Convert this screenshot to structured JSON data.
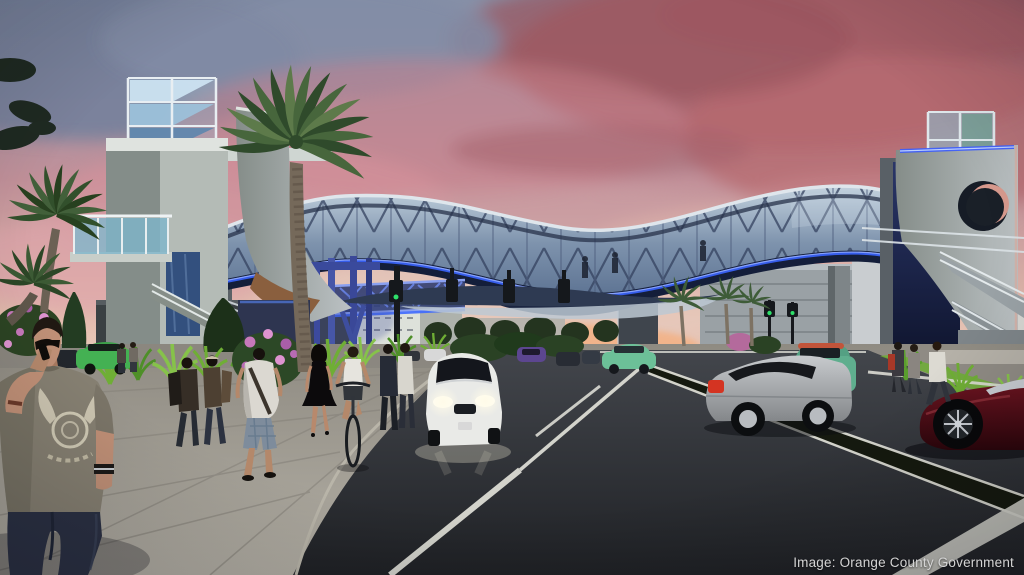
{
  "meta": {
    "type": "architectural-rendering",
    "subject": "Pedestrian bridge spanning a multi-lane road at dusk",
    "time_of_day": "sunset"
  },
  "caption": {
    "credit": "Image: Orange County Government"
  },
  "scene": {
    "elements": [
      "pink and mauve sunset sky with heavy clouds",
      "curved glass-and-steel truss pedestrian bridge with blue under-lighting",
      "left concrete stair/elevator tower with glass crown and glass balcony",
      "right concrete tower with circular cutout, navy panel and exterior stairs",
      "large palm tree in front of bridge, two palms at far left, three distant palms",
      "wing-shaped canopy and blue-lit truss walkway below the bridge",
      "traffic signals hanging beneath the bridge and on posts",
      "wide asphalt road with white lane lines and dark median strip",
      "light concrete sidewalk and plaza with ornamental grasses and pink flowering bushes",
      "foreground man in gray graphic t-shirt talking on phone",
      "pedestrians with backpacks, man in white top and plaid shorts, woman in black dress, cyclist, two standing men, people near right stairs",
      "white hatchback with headlights on, silver coupe, green SUV, green sedans, purple compact, dark red sports car",
      "distant buildings and parking garage at horizon with orange sunset glow"
    ],
    "colors": {
      "skyTop": "#8791a8",
      "skyRose": "#a85f68",
      "skyPink": "#d5939c",
      "skyHorizon": "#efd6c2",
      "sunsetGlow": "#f2b287",
      "bridgeGlass": "#a3b7cc",
      "bridgeSteel": "#31415f",
      "bridgeUnderglow": "#3a64ff",
      "towerConcrete": "#aeb5b1",
      "navyPanel": "#1f2a55",
      "roadAsphalt": "#43464c",
      "roadDark": "#1f2125",
      "sidewalk": "#a29e95",
      "laneMarking": "#dcdcd4",
      "grassGreen": "#6fae35",
      "palmGreen": "#46633a",
      "flowerPink": "#c778bb",
      "carWhite": "#e9eae7",
      "carSilver": "#b2b5b8",
      "carRed": "#4e0d16",
      "captionText": "#d4d4d4"
    }
  }
}
